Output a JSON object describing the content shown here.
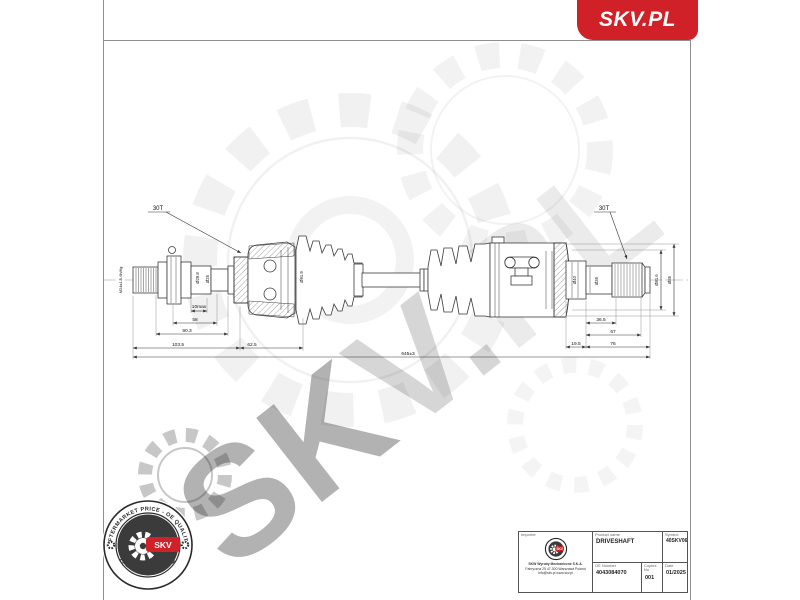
{
  "colors": {
    "brand_red": "#cf2127",
    "line": "#3a3a3a"
  },
  "brand": {
    "logo_text": "SKV.PL"
  },
  "watermark": {
    "seg1": "SK",
    "seg2": "V.",
    "seg3": "PL"
  },
  "drawing": {
    "labels": {
      "spline_left": "30T",
      "spline_right": "30T",
      "thread": "M24x1.5-6h/6g",
      "dia_shaft_1": "Ø29.8",
      "dia_shaft_2": "Ø25",
      "dia_boot": "Ø91.9",
      "dia_stub_1": "Ø40",
      "dia_stub_2": "Ø35",
      "dia_joint_1": "Ø81.6",
      "dia_joint_2": "Ø85"
    },
    "dims": {
      "d10max": "10max",
      "d58": "58",
      "d90_3": "90.3",
      "d103_5": "103.5",
      "d62_5": "62.5",
      "overall": "645±3",
      "d36_5": "36.5",
      "d67": "67",
      "d19_5": "19.5",
      "d76": "76"
    }
  },
  "badge": {
    "arc_top": "AFTERMARKET PRICE - OE QUALITY",
    "arc_bottom": "AUTO PARTS",
    "center": "SKV"
  },
  "title_block": {
    "importer": {
      "label": "Importer",
      "logo_text": "SKV",
      "company_lines": [
        "SKW Wyroby Mechaniczne S.K.A.",
        "Fabryczna 25 47-300 Warszawa Poland",
        "info@skv.pl  www.skv.pl"
      ]
    },
    "product": {
      "label": "Product name",
      "value": "DRIVESHAFT"
    },
    "symbol": {
      "label": "Symbol",
      "value": "40SKV065"
    },
    "oe": {
      "label": "OE Number",
      "value": "4043084070"
    },
    "copies": {
      "label": "Copies No",
      "value": "001"
    },
    "date": {
      "label": "Date",
      "value": "01/2025"
    }
  }
}
